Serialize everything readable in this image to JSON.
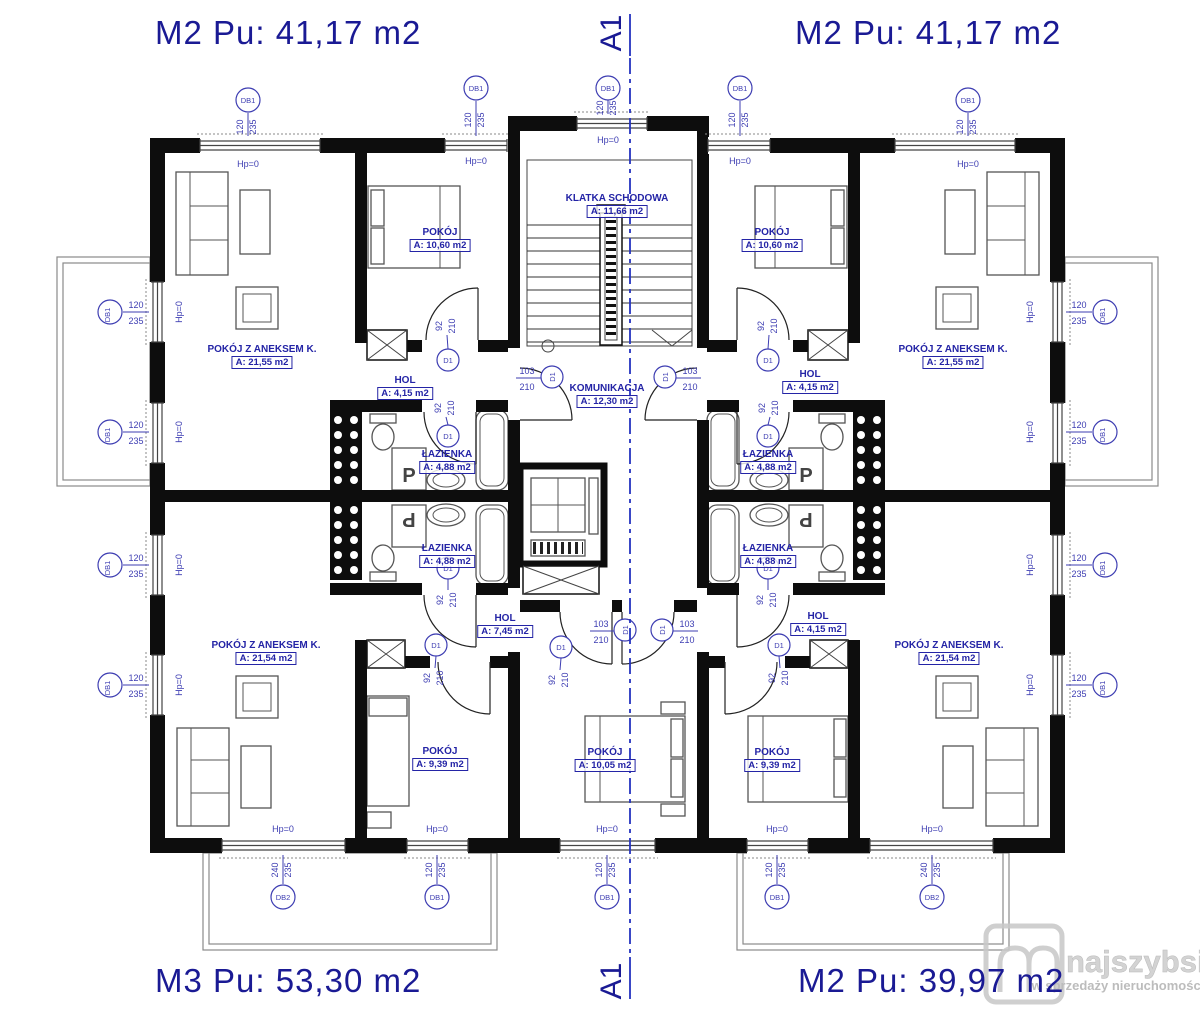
{
  "apartment_labels": {
    "top_left": "M2 Pu: 41,17 m2",
    "top_right": "M2 Pu: 41,17 m2",
    "bottom_left": "M3 Pu: 53,30 m2",
    "bottom_right": "M2 Pu: 39,97 m2"
  },
  "section_marker": "A1",
  "rooms": {
    "klatka": {
      "name": "KLATKA SCHODOWA",
      "area": "A: 11,66 m2"
    },
    "komunikacja": {
      "name": "KOMUNIKACJA",
      "area": "A: 12,30 m2"
    },
    "tl_living": {
      "name": "POKÓJ Z ANEKSEM K.",
      "area": "A: 21,55 m2"
    },
    "tl_pokoj": {
      "name": "POKÓJ",
      "area": "A: 10,60 m2"
    },
    "tl_hol": {
      "name": "HOL",
      "area": "A: 4,15 m2"
    },
    "tl_lazienka": {
      "name": "ŁAZIENKA",
      "area": "A: 4,88 m2"
    },
    "tr_living": {
      "name": "POKÓJ Z ANEKSEM K.",
      "area": "A: 21,55 m2"
    },
    "tr_pokoj": {
      "name": "POKÓJ",
      "area": "A: 10,60 m2"
    },
    "tr_hol": {
      "name": "HOL",
      "area": "A: 4,15 m2"
    },
    "tr_lazienka": {
      "name": "ŁAZIENKA",
      "area": "A: 4,88 m2"
    },
    "bl_living": {
      "name": "POKÓJ Z ANEKSEM K.",
      "area": "A: 21,54 m2"
    },
    "bl_pokoj": {
      "name": "POKÓJ",
      "area": "A: 9,39 m2"
    },
    "bl_hol": {
      "name": "HOL",
      "area": "A: 7,45 m2"
    },
    "bl_lazienka": {
      "name": "ŁAZIENKA",
      "area": "A: 4,88 m2"
    },
    "bc_pokoj": {
      "name": "POKÓJ",
      "area": "A: 10,05 m2"
    },
    "br_living": {
      "name": "POKÓJ Z ANEKSEM K.",
      "area": "A: 21,54 m2"
    },
    "br_pokoj": {
      "name": "POKÓJ",
      "area": "A: 9,39 m2"
    },
    "br_hol": {
      "name": "HOL",
      "area": "A: 4,15 m2"
    },
    "br_lazienka": {
      "name": "ŁAZIENKA",
      "area": "A: 4,88 m2"
    }
  },
  "markers": {
    "db1": "DB1",
    "db2": "DB2",
    "d1": "D1",
    "hp0": "Hp=0",
    "dim_120": "120",
    "dim_235": "235",
    "dim_240": "240",
    "dim_92": "92",
    "dim_210": "210",
    "dim_103": "103"
  },
  "fixtures": {
    "washer": "P"
  },
  "watermark": {
    "brand": "najszybsi",
    "tagline": "w sprzedaży nieruchomości"
  },
  "colors": {
    "label_blue": "#1a1a94",
    "room_label_blue": "#2424a6",
    "marker_blue": "#3d3db2",
    "wall_black": "#0d0d0d",
    "section_blue": "#2433c0",
    "watermark_gray": "#c9c9c9"
  }
}
